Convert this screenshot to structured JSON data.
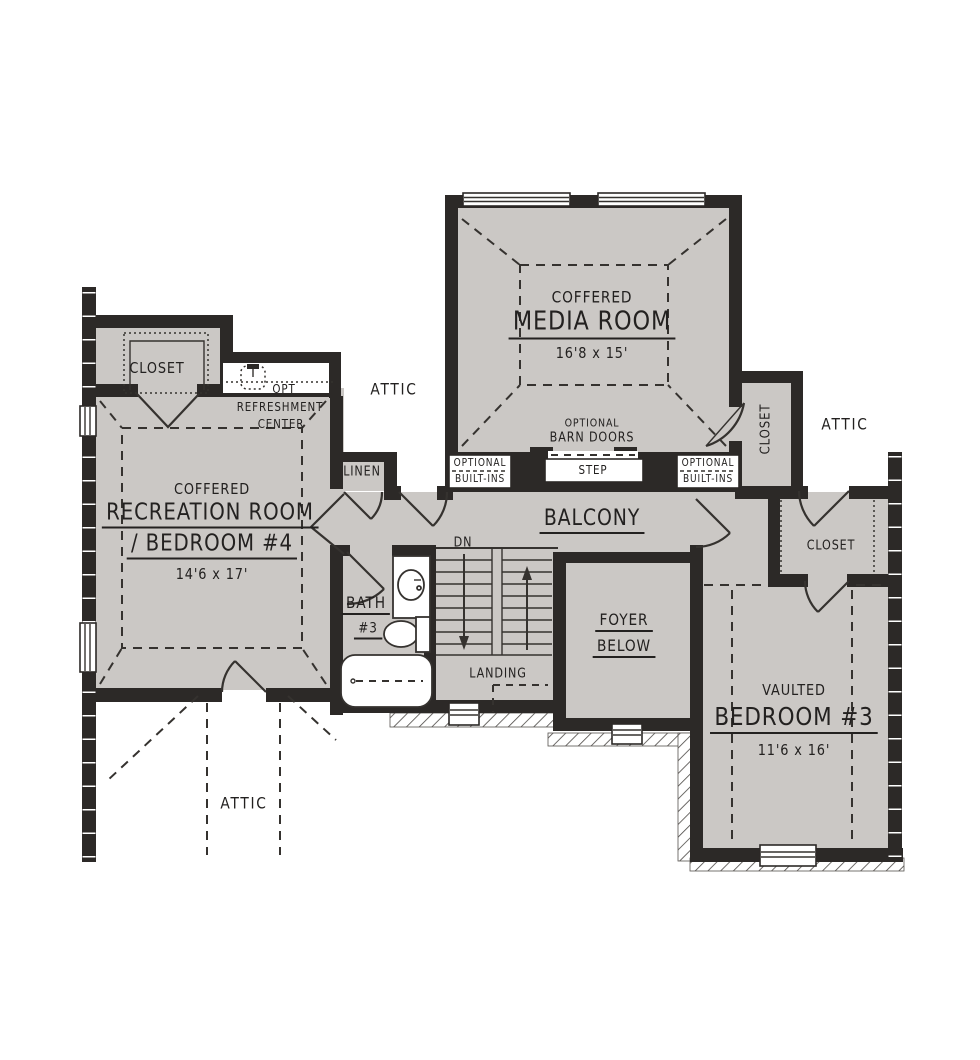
{
  "title": "Second Floor Plan",
  "colors": {
    "wall": "#2c2927",
    "floor": "#cbc8c5",
    "line": "#35322f",
    "text": "#232120"
  },
  "rooms": {
    "media": {
      "sub": "COFFERED",
      "name": "MEDIA ROOM",
      "dims": "16'8 x 15'"
    },
    "recreation": {
      "sub": "COFFERED",
      "name": "RECREATION ROOM",
      "name2": "/ BEDROOM #4",
      "dims": "14'6 x 17'"
    },
    "bedroom3": {
      "sub": "VAULTED",
      "name": "BEDROOM #3",
      "dims": "11'6 x 16'"
    },
    "bath3": {
      "name": "BATH",
      "number": "#3"
    },
    "foyer": {
      "line1": "FOYER",
      "line2": "BELOW"
    },
    "balcony": {
      "name": "BALCONY"
    },
    "linen": {
      "name": "LINEN"
    },
    "closet_top_left": {
      "name": "CLOSET"
    },
    "closet_media": {
      "name": "CLOSET"
    },
    "closet_bedroom": {
      "name": "CLOSET"
    }
  },
  "labels": {
    "attic_top": "ATTIC",
    "attic_right": "ATTIC",
    "attic_bottom": "ATTIC",
    "dn": "DN",
    "landing": "LANDING",
    "step": "STEP",
    "opt": "OPT",
    "refreshment": "REFRESHMENT",
    "center": "CENTER",
    "optional": "OPTIONAL",
    "built_ins": "BUILT-INS",
    "barn_optional": "OPTIONAL",
    "barn_doors": "BARN DOORS"
  }
}
